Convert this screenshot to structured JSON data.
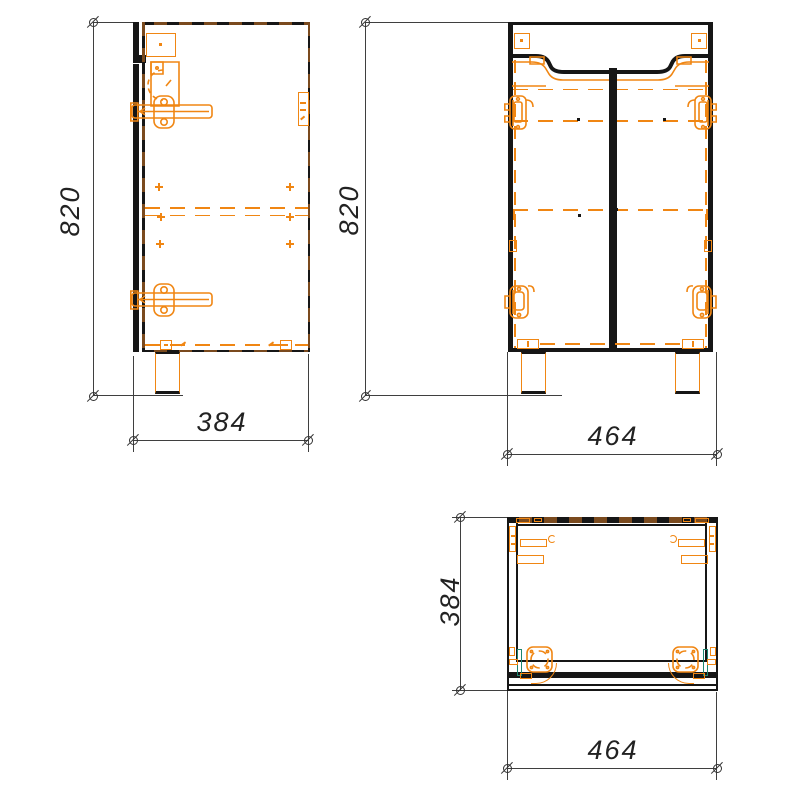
{
  "drawing": {
    "dimensions": {
      "side_height": "820",
      "side_depth": "384",
      "front_height": "820",
      "front_width": "464",
      "top_depth": "384",
      "top_width": "464"
    },
    "colors": {
      "hardware_orange": "#F08613",
      "panel_brown": "#7A4A1E",
      "line_black": "#161616",
      "dimension_gray": "#3F3F3F",
      "accent_teal": "#1D8570",
      "background": "#FFFFFF"
    }
  }
}
